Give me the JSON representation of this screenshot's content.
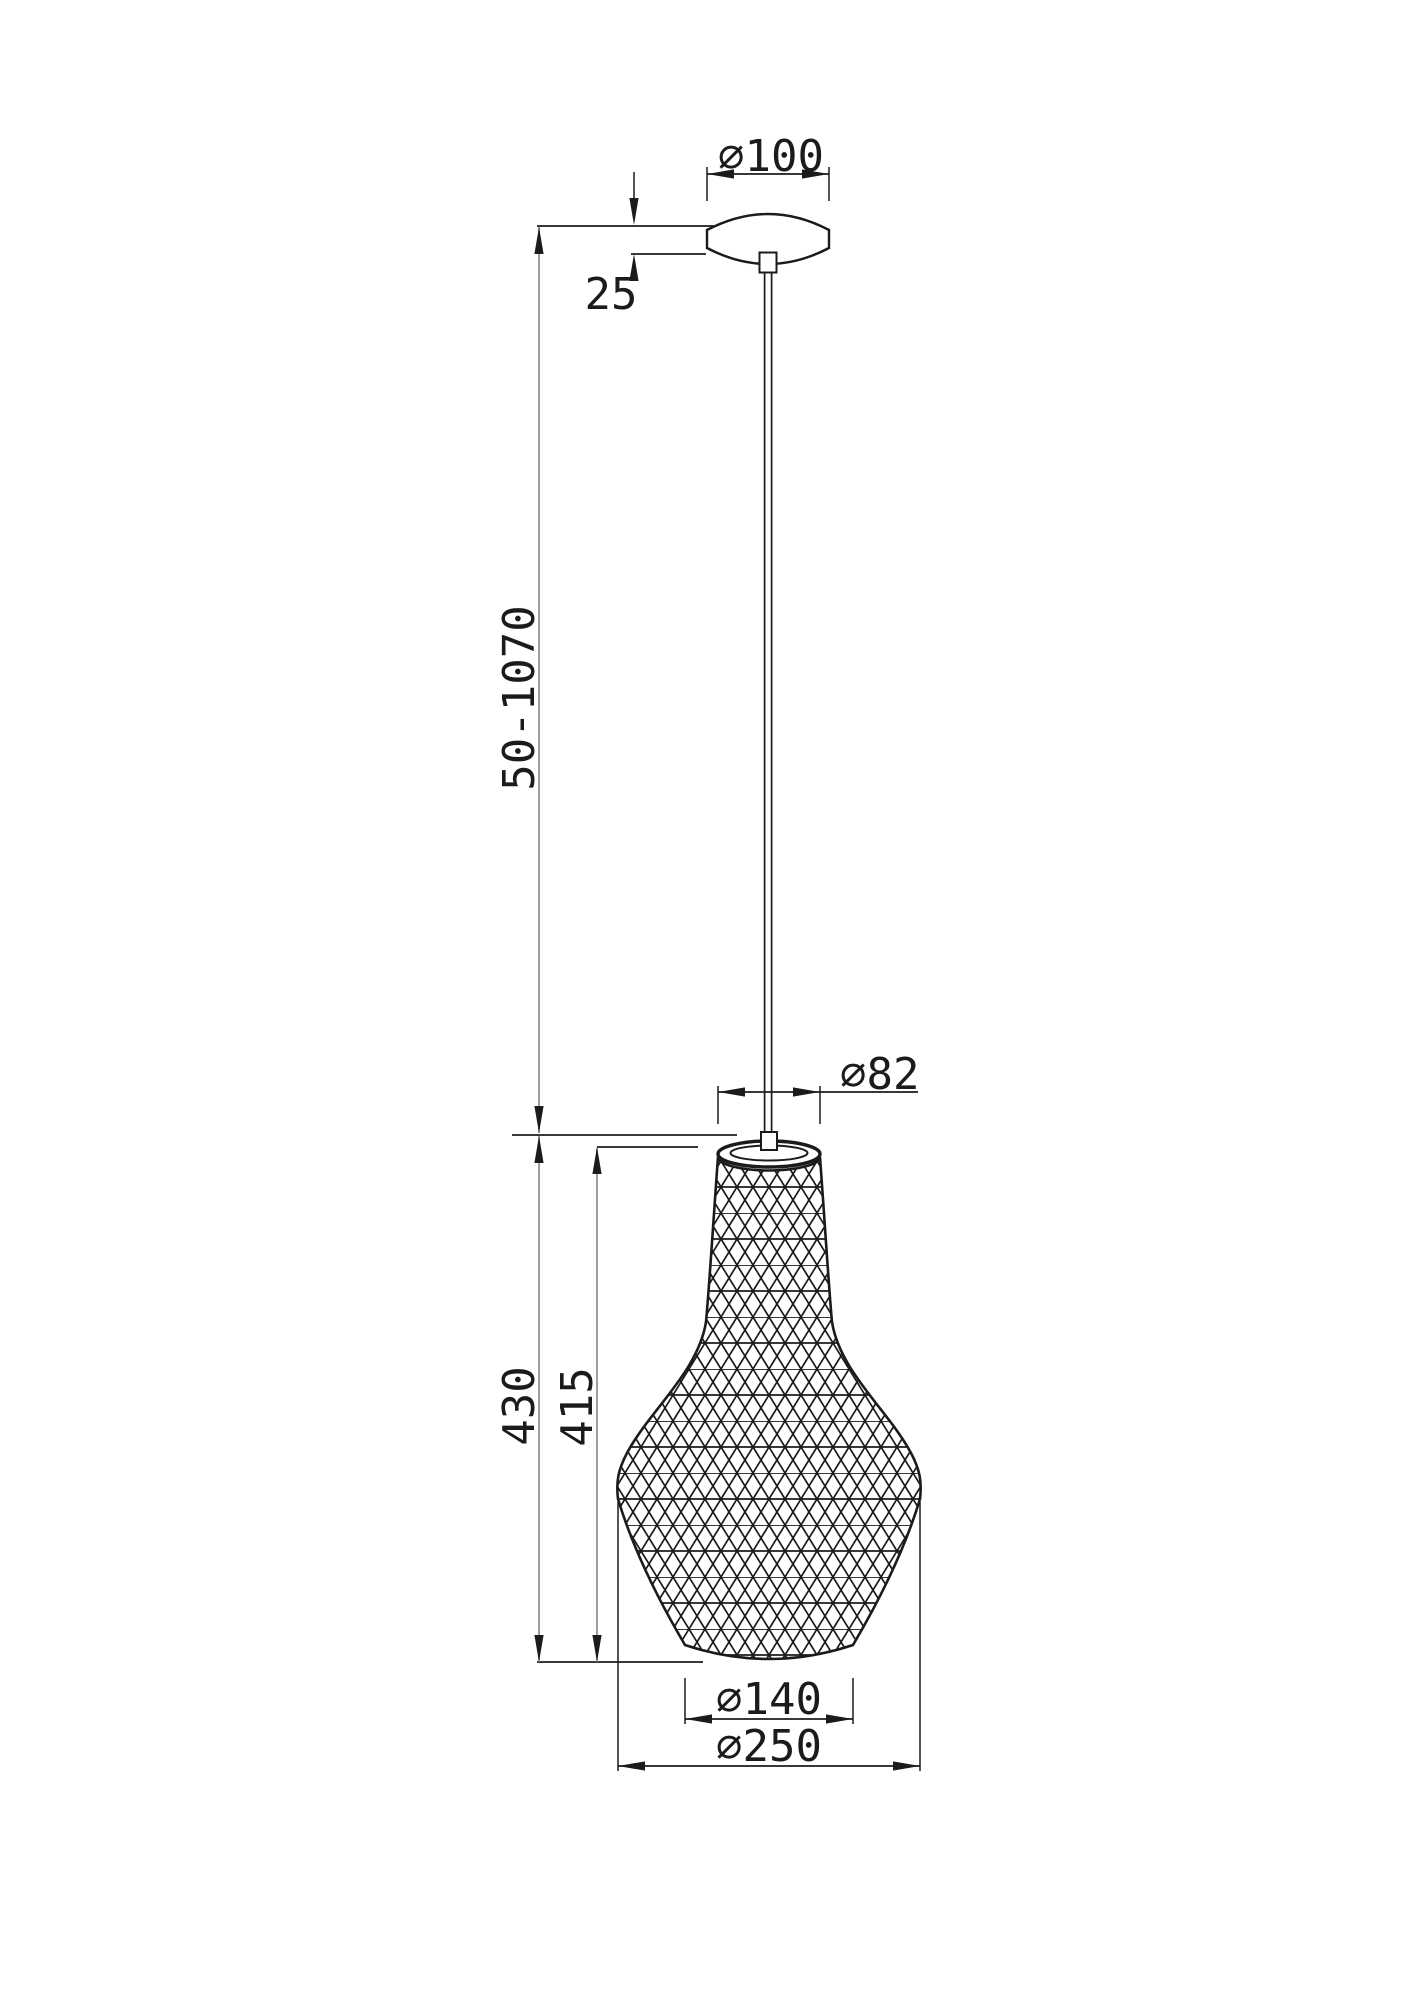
{
  "drawing": {
    "type": "pendant-lamp-technical-drawing",
    "dimensions": {
      "canopy_diameter": "⌀100",
      "canopy_height": "25",
      "suspension_range": "50-1070",
      "neck_diameter": "⌀82",
      "shade_height_total": "430",
      "shade_height_body": "415",
      "bottom_opening_diameter": "⌀140",
      "shade_max_diameter": "⌀250"
    },
    "colors": {
      "object_line": "#1b1b1b",
      "dimension_line": "#1b1b1b",
      "long_dimension_guide": "#8c8c8c",
      "background": "#ffffff"
    }
  }
}
